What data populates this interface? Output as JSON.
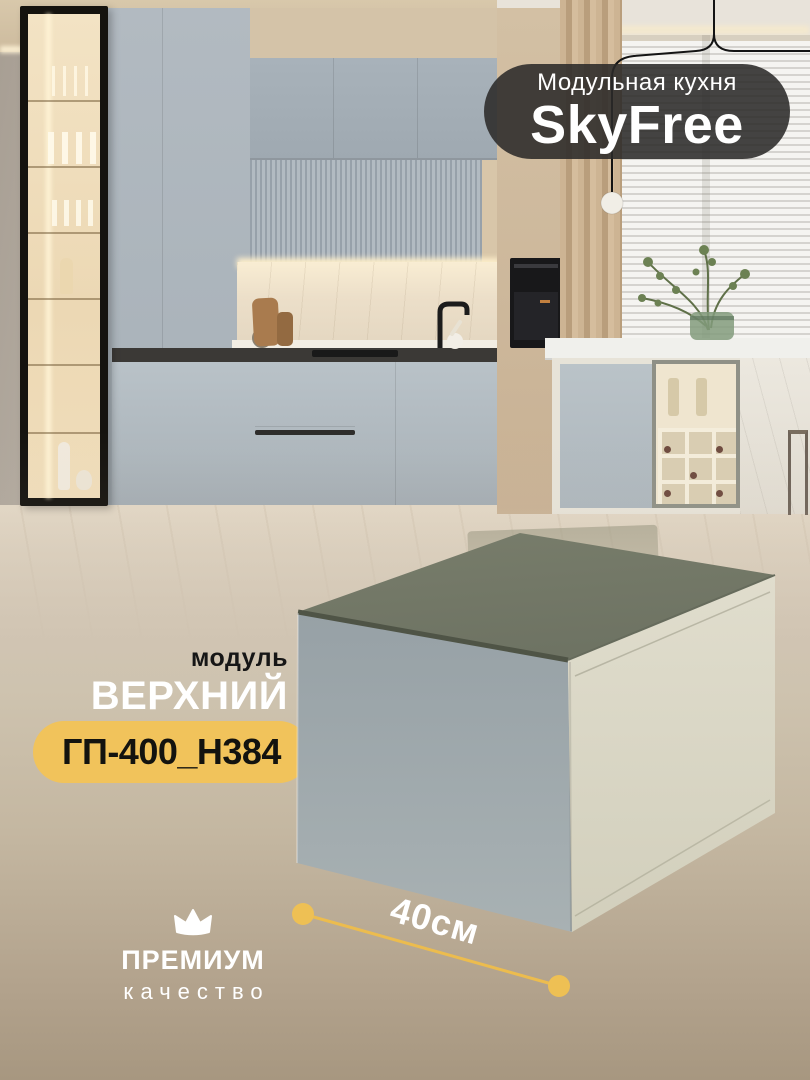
{
  "badge": {
    "subtitle": "Модульная кухня",
    "title": "SkyFree"
  },
  "module": {
    "kicker": "модуль",
    "name": "ВЕРХНИЙ"
  },
  "sku": {
    "code": "ГП-400_Н384"
  },
  "dimension": {
    "width_label": "40см"
  },
  "premium": {
    "line1": "ПРЕМИУМ",
    "line2": "качество",
    "icon": "crown-icon"
  },
  "colors": {
    "accent_yellow": "#F1C35B",
    "dimension_line": "#ECBC4E",
    "badge_background": "#2B2A29",
    "backdrop_bottom": "#A79780",
    "cabinet_front_face": "#9FA9AD",
    "cabinet_side_face": "#DCD9C9",
    "cabinet_top_face": "#737866"
  }
}
